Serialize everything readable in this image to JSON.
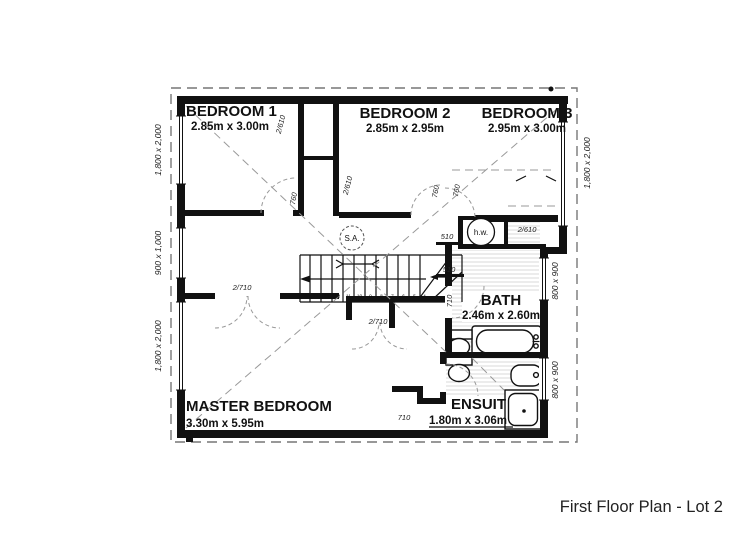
{
  "title": "First Floor Plan - Lot 2",
  "rooms": {
    "bedroom1": {
      "name": "BEDROOM 1",
      "dims": "2.85m x 3.00m"
    },
    "bedroom2": {
      "name": "BEDROOM 2",
      "dims": "2.85m x 2.95m"
    },
    "bedroom3": {
      "name": "BEDROOM 3",
      "dims": "2.95m x 3.00m"
    },
    "bath": {
      "name": "BATH",
      "dims": "2.46m x 2.60m"
    },
    "ensuite": {
      "name": "ENSUIT",
      "dims": "1.80m x 3.06m"
    },
    "master": {
      "name": "MASTER BEDROOM",
      "dims": "3.30m x 5.95m"
    }
  },
  "windows": {
    "left_top": "1,800 x 2,000",
    "left_mid": "900 x 1,000",
    "left_bottom": "1,800 x 2,000",
    "right_top": "1,800 x 2,000",
    "right_mid": "800 x 900",
    "right_bottom": "800 x 900"
  },
  "doors": {
    "bed1_robe": "2/610",
    "bed2_robe": "2/610",
    "linen": "2/610",
    "bed1": "760",
    "bed2": "760",
    "bed3": "760",
    "cupboard_top": "510",
    "cupboard_bottom": "510",
    "bath": "710",
    "ensuite": "710",
    "master_entry": "2/710",
    "master_robe": "2/710"
  },
  "annotations": {
    "smoke_alarm": "S.A.",
    "hot_water": "h.w."
  },
  "stairs": {
    "treads": [
      "15",
      "14",
      "13",
      "12",
      "11",
      "10",
      "9",
      "8",
      "7",
      "6",
      "5",
      "4"
    ]
  }
}
